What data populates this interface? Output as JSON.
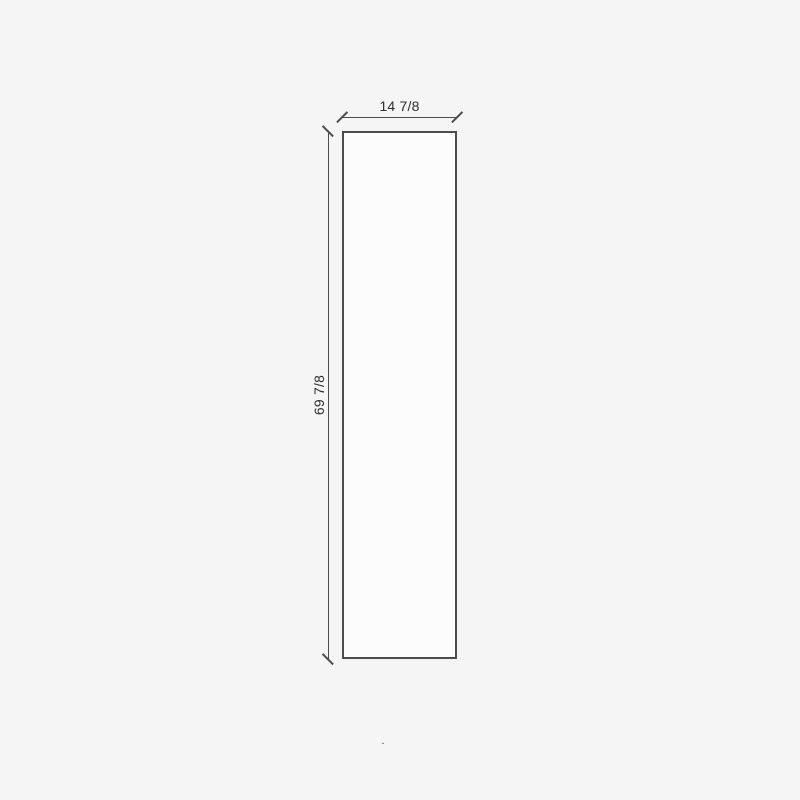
{
  "diagram": {
    "type": "dimensioned-panel-drawing",
    "panel": {
      "width_label": "14 7/8",
      "height_label": "69 7/8"
    },
    "stray_mark": "."
  },
  "colors": {
    "background": "#f5f5f5",
    "panel_fill": "#fcfcfc",
    "line": "#4d4d4d",
    "outline": "#4c4c4c",
    "text": "#2e2e2e"
  }
}
